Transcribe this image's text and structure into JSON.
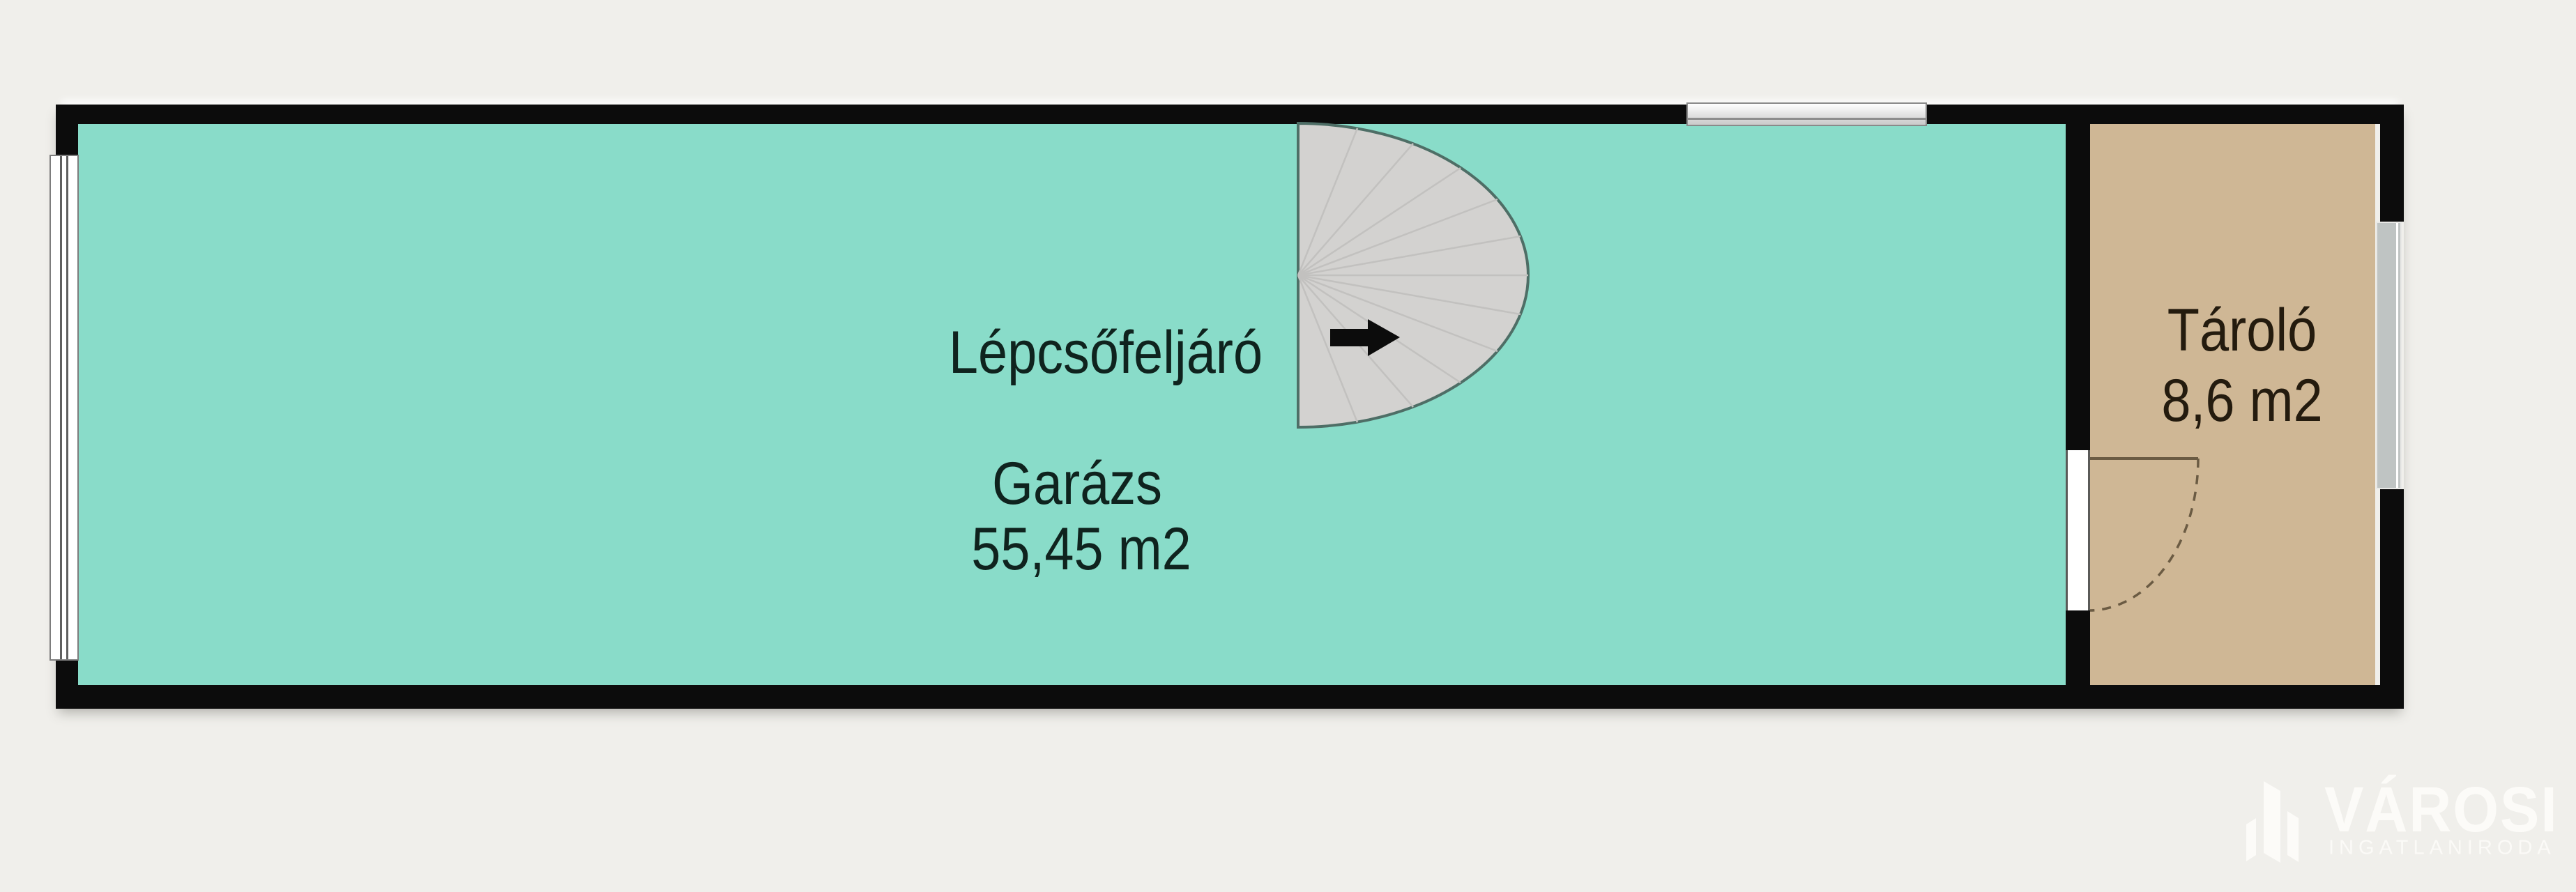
{
  "floorplan": {
    "stair": {
      "label": "Lépcsőfeljáró",
      "direction_arrow": "right"
    },
    "rooms": [
      {
        "id": "garage",
        "label": "Garázs",
        "area": "55,45 m2",
        "fill": "#89dcc9"
      },
      {
        "id": "storage",
        "label": "Tároló",
        "area": "8,6 m2",
        "fill": "#cfb795"
      }
    ],
    "colors": {
      "background": "#f0efeb",
      "wall": "#0c0c0c",
      "stair_fill": "#d3d2d0",
      "stair_outline": "#4e6e66",
      "garage_label": "#0f231e",
      "storage_label": "#241b0e",
      "door_line": "#6b5b43",
      "watermark": "#fbfaf7"
    },
    "watermark": {
      "title": "VÁROSI",
      "subtitle": "INGATLANIRODA"
    }
  }
}
